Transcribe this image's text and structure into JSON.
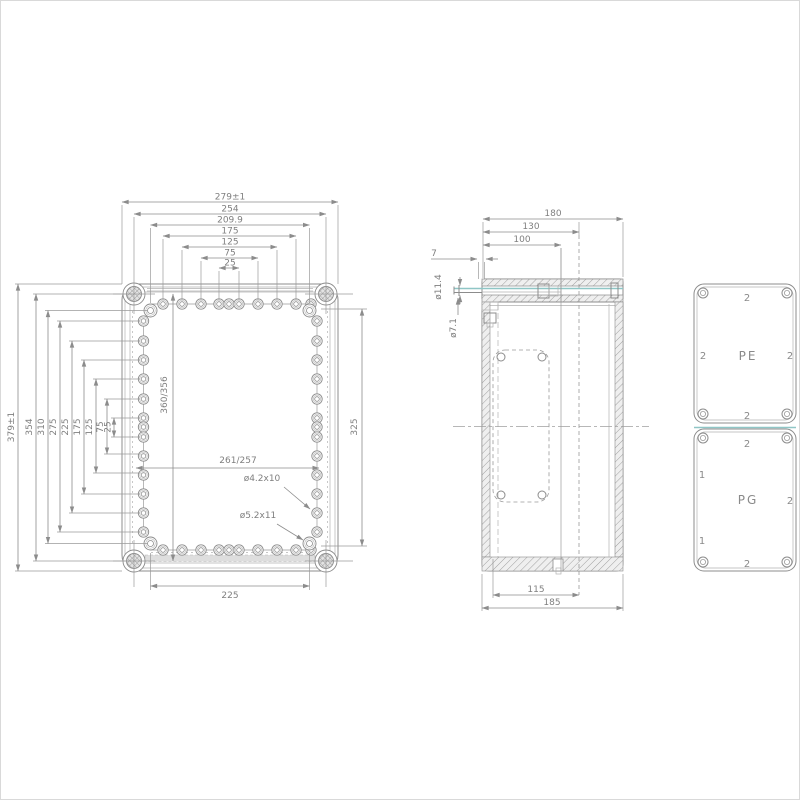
{
  "front_view": {
    "dims_top": {
      "d279": "279±1",
      "d254": "254",
      "d209": "209.9",
      "d175": "175",
      "d125": "125",
      "d75": "75",
      "d25": "25"
    },
    "dims_left": {
      "d379": "379±1",
      "d354": "354",
      "d310": "310",
      "d275": "275",
      "d225": "225",
      "d175": "175",
      "d125": "125",
      "d75": "75",
      "d25": "25"
    },
    "dim_inner_height": "360/356",
    "dim_inner_width": "261/257",
    "dim_right": "325",
    "dim_bottom": "225",
    "note_hole_small": "ø4.2x10",
    "note_hole_large": "ø5.2x11"
  },
  "side_view": {
    "dims_top": {
      "d180": "180",
      "d130": "130",
      "d100": "100",
      "d7": "7"
    },
    "dim_screw_outer": "ø11.4",
    "dim_screw_inner": "ø7.1",
    "dims_bottom": {
      "d115": "115",
      "d185": "185"
    }
  },
  "panels": {
    "pe": {
      "label": "PE",
      "top": "2",
      "left": "2",
      "right": "2",
      "bottom": "2"
    },
    "pg": {
      "label": "PG",
      "top": "2",
      "upper_left": "1",
      "right": "2",
      "lower_left": "1",
      "bottom": "2"
    }
  },
  "colors": {
    "line": "#8c8c8c",
    "text": "#7f7f7f",
    "accent": "#8fc6c6"
  }
}
